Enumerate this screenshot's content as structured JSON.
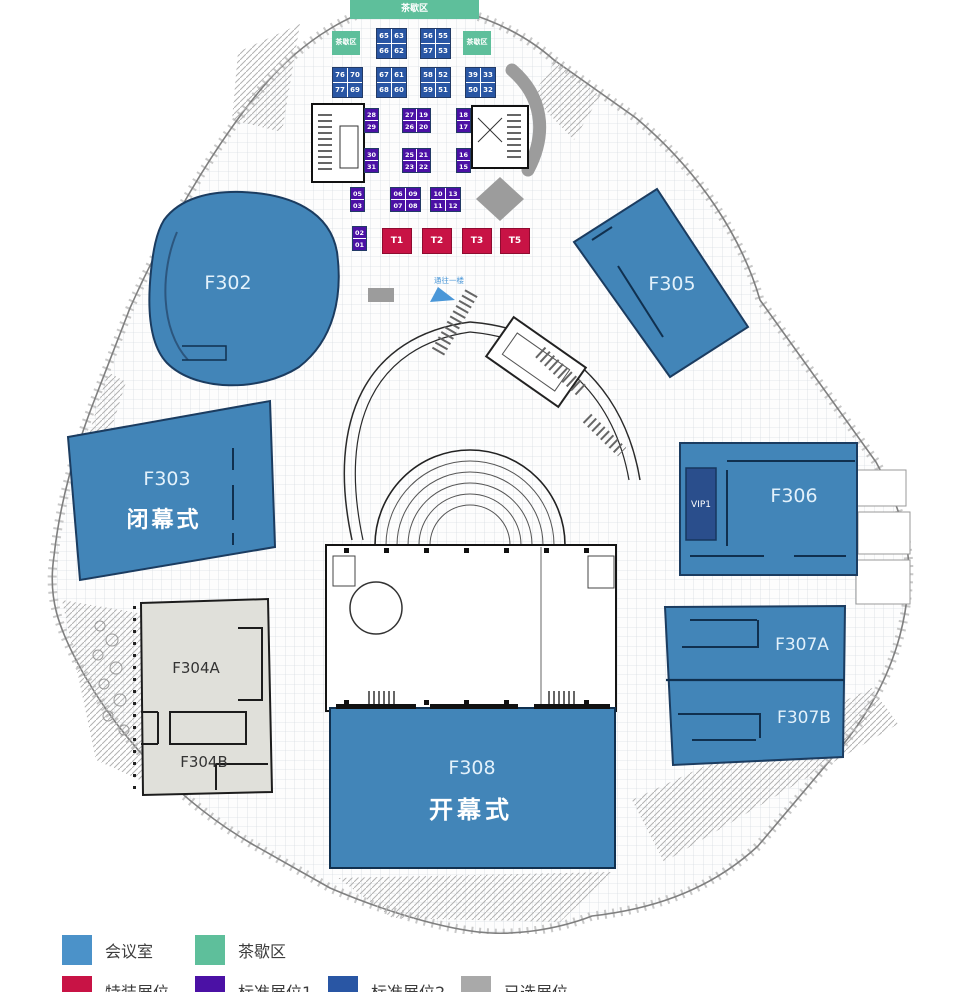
{
  "colors": {
    "room": "#4285b8",
    "room_border": "#1b3c60",
    "room_label": "#e2f1fb",
    "special": "#c81345",
    "standard1": "#4b11a5",
    "standard2": "#2956a4",
    "selected": "#a9a9a9",
    "tea": "#5ebf9b",
    "vip": "#2a4e8c",
    "gray_room": "#e0e0da",
    "gray_shape": "#9c9c9c",
    "legend_meeting": "#4b92c9"
  },
  "rooms": {
    "f302": {
      "label": "F302"
    },
    "f303": {
      "label": "F303",
      "sub": "闭幕式"
    },
    "f304a": {
      "label": "F304A"
    },
    "f304b": {
      "label": "F304B"
    },
    "f305": {
      "label": "F305"
    },
    "f306": {
      "label": "F306"
    },
    "vip1": {
      "label": "VIP1"
    },
    "f307a": {
      "label": "F307A"
    },
    "f307b": {
      "label": "F307B"
    },
    "f308": {
      "label": "F308",
      "sub": "开幕式"
    }
  },
  "notes": {
    "escalator": "通往一楼"
  },
  "tea_areas": [
    {
      "x": 350,
      "y": 0,
      "w": 129,
      "h": 19,
      "fs": 9,
      "label": "茶歇区"
    },
    {
      "x": 332,
      "y": 31,
      "w": 28,
      "h": 24,
      "fs": 7,
      "label": "茶歇区"
    },
    {
      "x": 463,
      "y": 31,
      "w": 28,
      "h": 24,
      "fs": 7,
      "label": "茶歇区"
    }
  ],
  "booth_groups": [
    {
      "type": "standard2",
      "x": 376,
      "y": 28,
      "cw": 14,
      "ch": 14,
      "fs": 7,
      "cells": [
        [
          "65",
          "63"
        ],
        [
          "66",
          "62"
        ]
      ]
    },
    {
      "type": "standard2",
      "x": 420,
      "y": 28,
      "cw": 14,
      "ch": 14,
      "fs": 7,
      "cells": [
        [
          "56",
          "55"
        ],
        [
          "57",
          "53"
        ]
      ]
    },
    {
      "type": "standard2",
      "x": 332,
      "y": 67,
      "cw": 14,
      "ch": 14,
      "fs": 7,
      "cells": [
        [
          "76",
          "70"
        ],
        [
          "77",
          "69"
        ]
      ]
    },
    {
      "type": "standard2",
      "x": 376,
      "y": 67,
      "cw": 14,
      "ch": 14,
      "fs": 7,
      "cells": [
        [
          "67",
          "61"
        ],
        [
          "68",
          "60"
        ]
      ]
    },
    {
      "type": "standard2",
      "x": 420,
      "y": 67,
      "cw": 14,
      "ch": 14,
      "fs": 7,
      "cells": [
        [
          "58",
          "52"
        ],
        [
          "59",
          "51"
        ]
      ]
    },
    {
      "type": "standard2",
      "x": 465,
      "y": 67,
      "cw": 14,
      "ch": 14,
      "fs": 7,
      "cells": [
        [
          "39",
          "33"
        ],
        [
          "50",
          "32"
        ]
      ]
    },
    {
      "type": "standard1",
      "x": 364,
      "y": 108,
      "cw": 13,
      "ch": 11,
      "fs": 6.5,
      "cells": [
        [
          "28"
        ],
        [
          "29"
        ]
      ]
    },
    {
      "type": "standard1",
      "x": 402,
      "y": 108,
      "cw": 13,
      "ch": 11,
      "fs": 6.5,
      "cells": [
        [
          "27",
          "19"
        ],
        [
          "26",
          "20"
        ]
      ]
    },
    {
      "type": "standard1",
      "x": 456,
      "y": 108,
      "cw": 13,
      "ch": 11,
      "fs": 6.5,
      "cells": [
        [
          "18"
        ],
        [
          "17"
        ]
      ]
    },
    {
      "type": "standard1",
      "x": 364,
      "y": 148,
      "cw": 13,
      "ch": 11,
      "fs": 6.5,
      "cells": [
        [
          "30"
        ],
        [
          "31"
        ]
      ]
    },
    {
      "type": "standard1",
      "x": 402,
      "y": 148,
      "cw": 13,
      "ch": 11,
      "fs": 6.5,
      "cells": [
        [
          "25",
          "21"
        ],
        [
          "23",
          "22"
        ]
      ]
    },
    {
      "type": "standard1",
      "x": 456,
      "y": 148,
      "cw": 13,
      "ch": 11,
      "fs": 6.5,
      "cells": [
        [
          "16"
        ],
        [
          "15"
        ]
      ]
    },
    {
      "type": "standard1",
      "x": 350,
      "y": 187,
      "cw": 13,
      "ch": 11,
      "fs": 6.5,
      "cells": [
        [
          "05"
        ],
        [
          "03"
        ]
      ]
    },
    {
      "type": "standard1",
      "x": 390,
      "y": 187,
      "cw": 14,
      "ch": 11,
      "fs": 6.5,
      "cells": [
        [
          "06",
          "09"
        ],
        [
          "07",
          "08"
        ]
      ]
    },
    {
      "type": "standard1",
      "x": 430,
      "y": 187,
      "cw": 14,
      "ch": 11,
      "fs": 6.5,
      "cells": [
        [
          "10",
          "13"
        ],
        [
          "11",
          "12"
        ]
      ]
    },
    {
      "type": "standard1",
      "x": 352,
      "y": 226,
      "cw": 13,
      "ch": 11,
      "fs": 6.5,
      "cells": [
        [
          "02"
        ],
        [
          "01"
        ]
      ]
    }
  ],
  "t_booths": {
    "y": 228,
    "w": 28,
    "h": 24,
    "items": [
      {
        "x": 382,
        "label": "T1"
      },
      {
        "x": 422,
        "label": "T2"
      },
      {
        "x": 462,
        "label": "T3"
      },
      {
        "x": 500,
        "label": "T5"
      }
    ]
  },
  "legend": {
    "rows": [
      [
        {
          "label": "会议室",
          "color": "#4b92c9"
        },
        {
          "label": "茶歇区",
          "color": "#5ebf9b"
        }
      ],
      [
        {
          "label": "特装展位",
          "color": "#c81345"
        },
        {
          "label": "标准展位1",
          "color": "#4b11a5"
        },
        {
          "label": "标准展位2",
          "color": "#2956a4"
        },
        {
          "label": "已选展位",
          "color": "#a9a9a9"
        }
      ]
    ]
  }
}
